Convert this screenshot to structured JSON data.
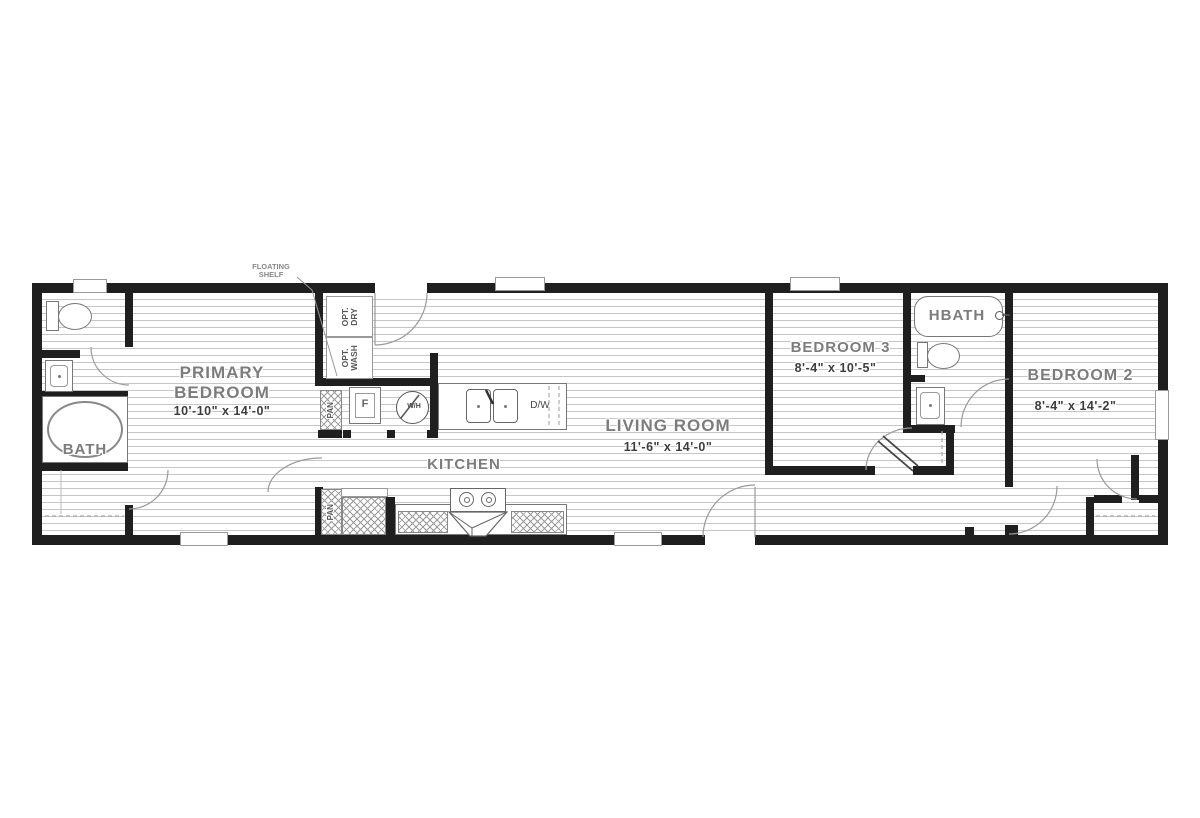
{
  "floorplan": {
    "annotations": {
      "floating_shelf": "FLOATING SHELF"
    },
    "rooms": {
      "bath": {
        "name": "BATH"
      },
      "primary_bedroom": {
        "name": "PRIMARY BEDROOM",
        "dims": "10'-10\" x  14'-0\""
      },
      "kitchen": {
        "name": "KITCHEN"
      },
      "living_room": {
        "name": "LIVING ROOM",
        "dims": "11'-6\" x  14'-0\""
      },
      "bedroom3": {
        "name": "BEDROOM 3",
        "dims": "8'-4\" x  10'-5\""
      },
      "hbath": {
        "name": "HBATH"
      },
      "bedroom2": {
        "name": "BEDROOM 2",
        "dims": "8'-4\" x  14'-2\""
      }
    },
    "fixtures": {
      "opt_dry": "OPT. DRY",
      "opt_wash": "OPT. WASH",
      "pantry_upper": "PAN",
      "pantry_lower": "PAN",
      "fridge": "F",
      "water_heater": "W/H",
      "dishwasher": "D/W"
    },
    "colors": {
      "wall": "#1f1f1f",
      "room_name": "#7c7c7c",
      "dims": "#3c3c3c",
      "floor_line": "#c6c6c6",
      "fixture_line": "#777777"
    }
  }
}
